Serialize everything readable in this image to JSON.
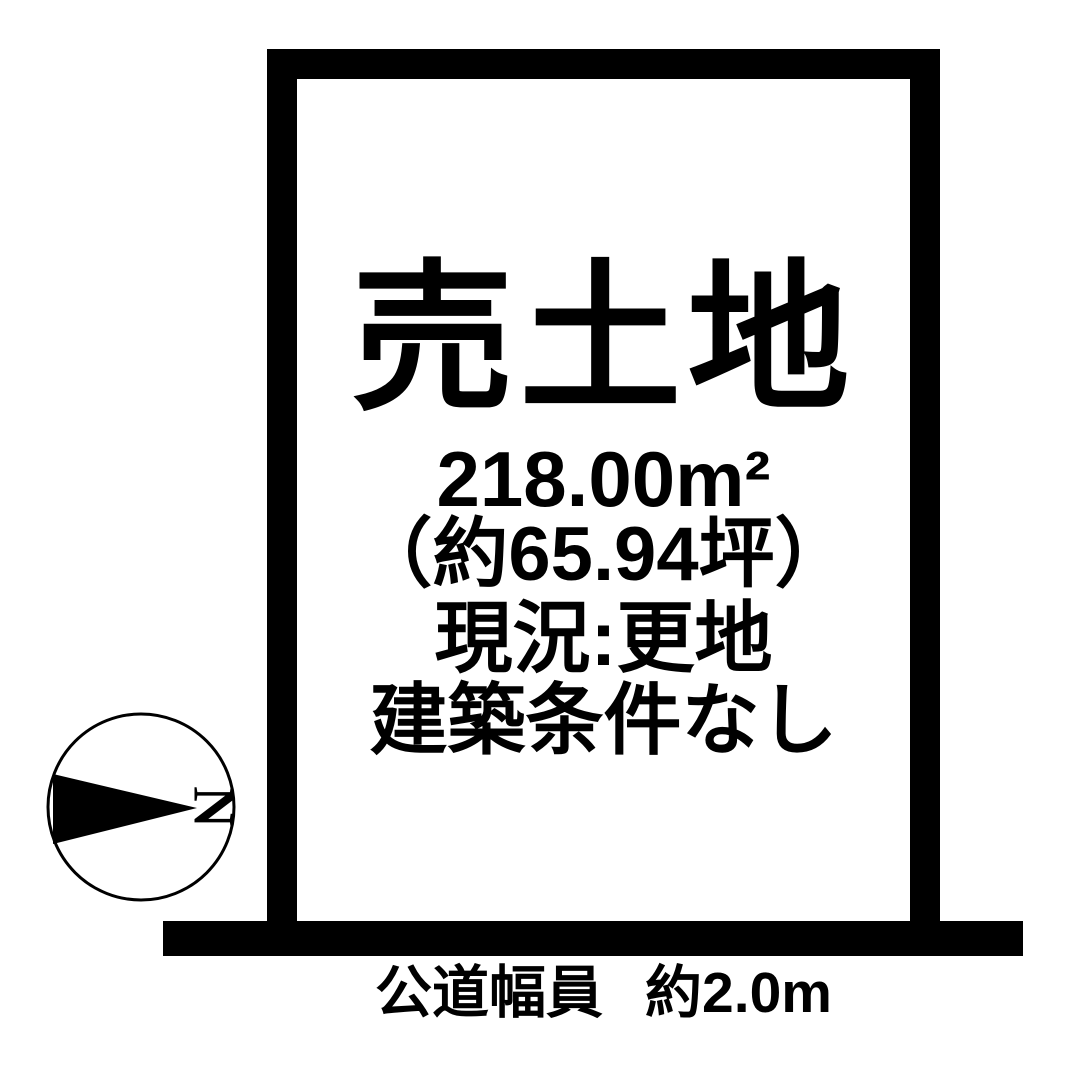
{
  "colors": {
    "ink": "#000000",
    "background": "#ffffff"
  },
  "plot": {
    "title": "売土地",
    "area_sqm": "218.00m²",
    "area_tsubo": "（約65.94坪）",
    "status": "現況:更地",
    "conditions": "建築条件なし"
  },
  "road": {
    "label": "公道幅員",
    "width": "約2.0m"
  },
  "compass": {
    "north_label": "N"
  }
}
